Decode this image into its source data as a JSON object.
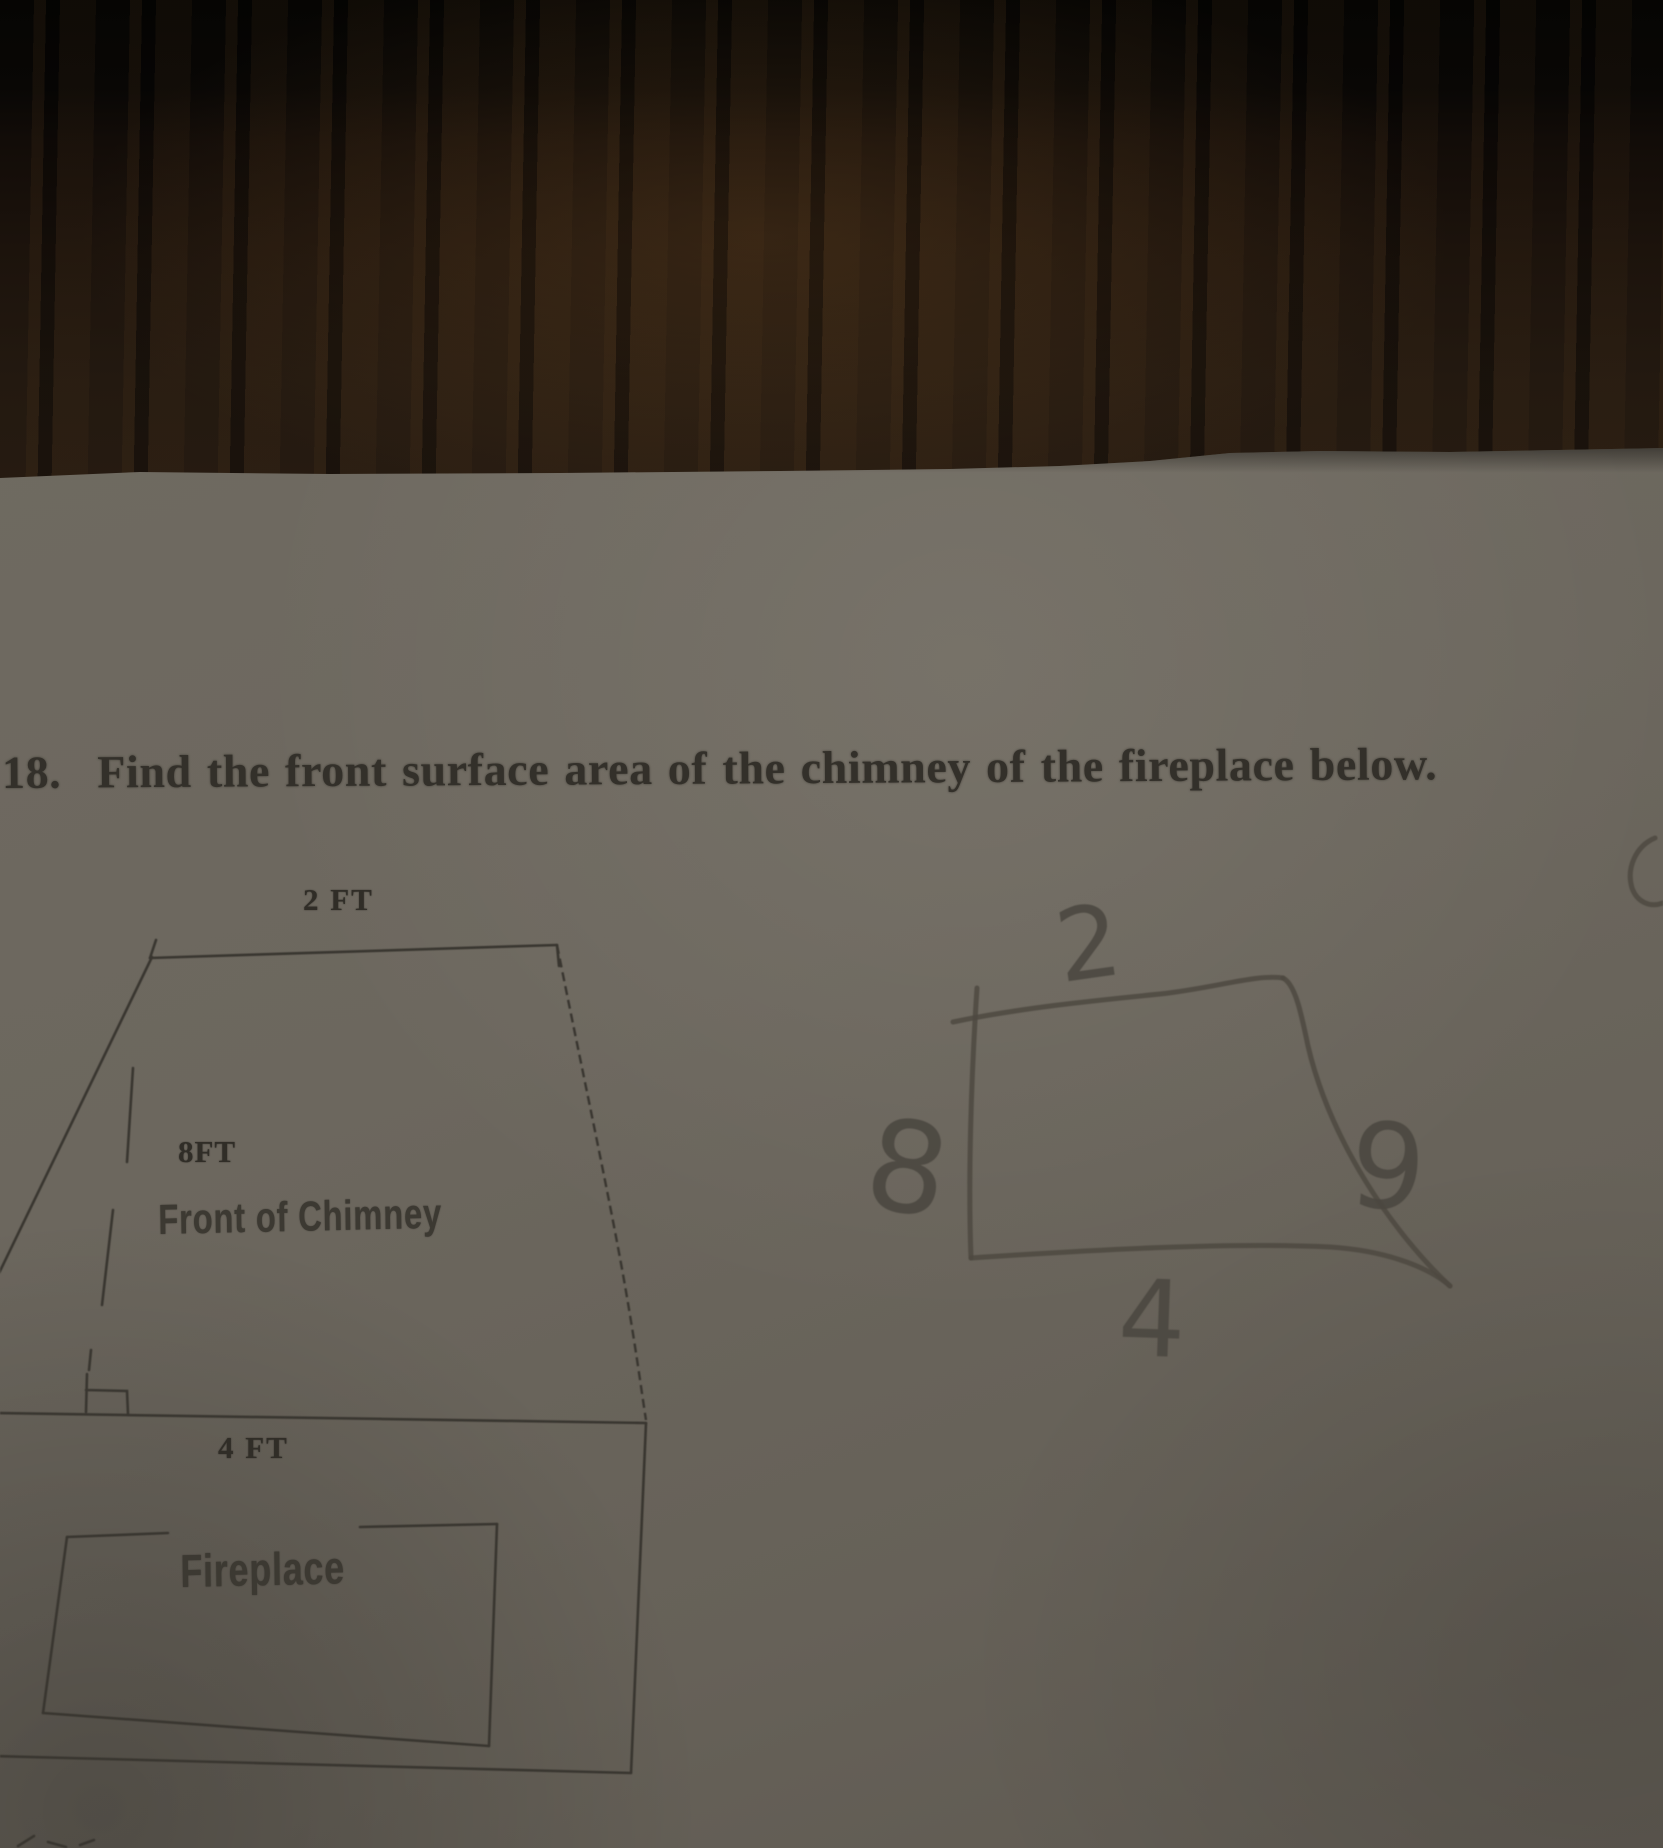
{
  "question": {
    "number": "18.",
    "text": "Find the front surface area of the chimney of the fireplace below."
  },
  "printed_figure": {
    "top_label": "2 FT",
    "height_label": "8FT",
    "face_label": "Front of Chimney",
    "bottom_label": "4 FT",
    "fireplace_label": "Fireplace"
  },
  "sketch": {
    "top_value": "2",
    "left_value": "8",
    "right_value": "9",
    "bottom_value": "4"
  },
  "colors": {
    "paper": "#6c675e",
    "wood_dark": "#0a0705",
    "wood_mid": "#241910",
    "printed_ink": "#393630",
    "pencil": "#4d4941"
  }
}
